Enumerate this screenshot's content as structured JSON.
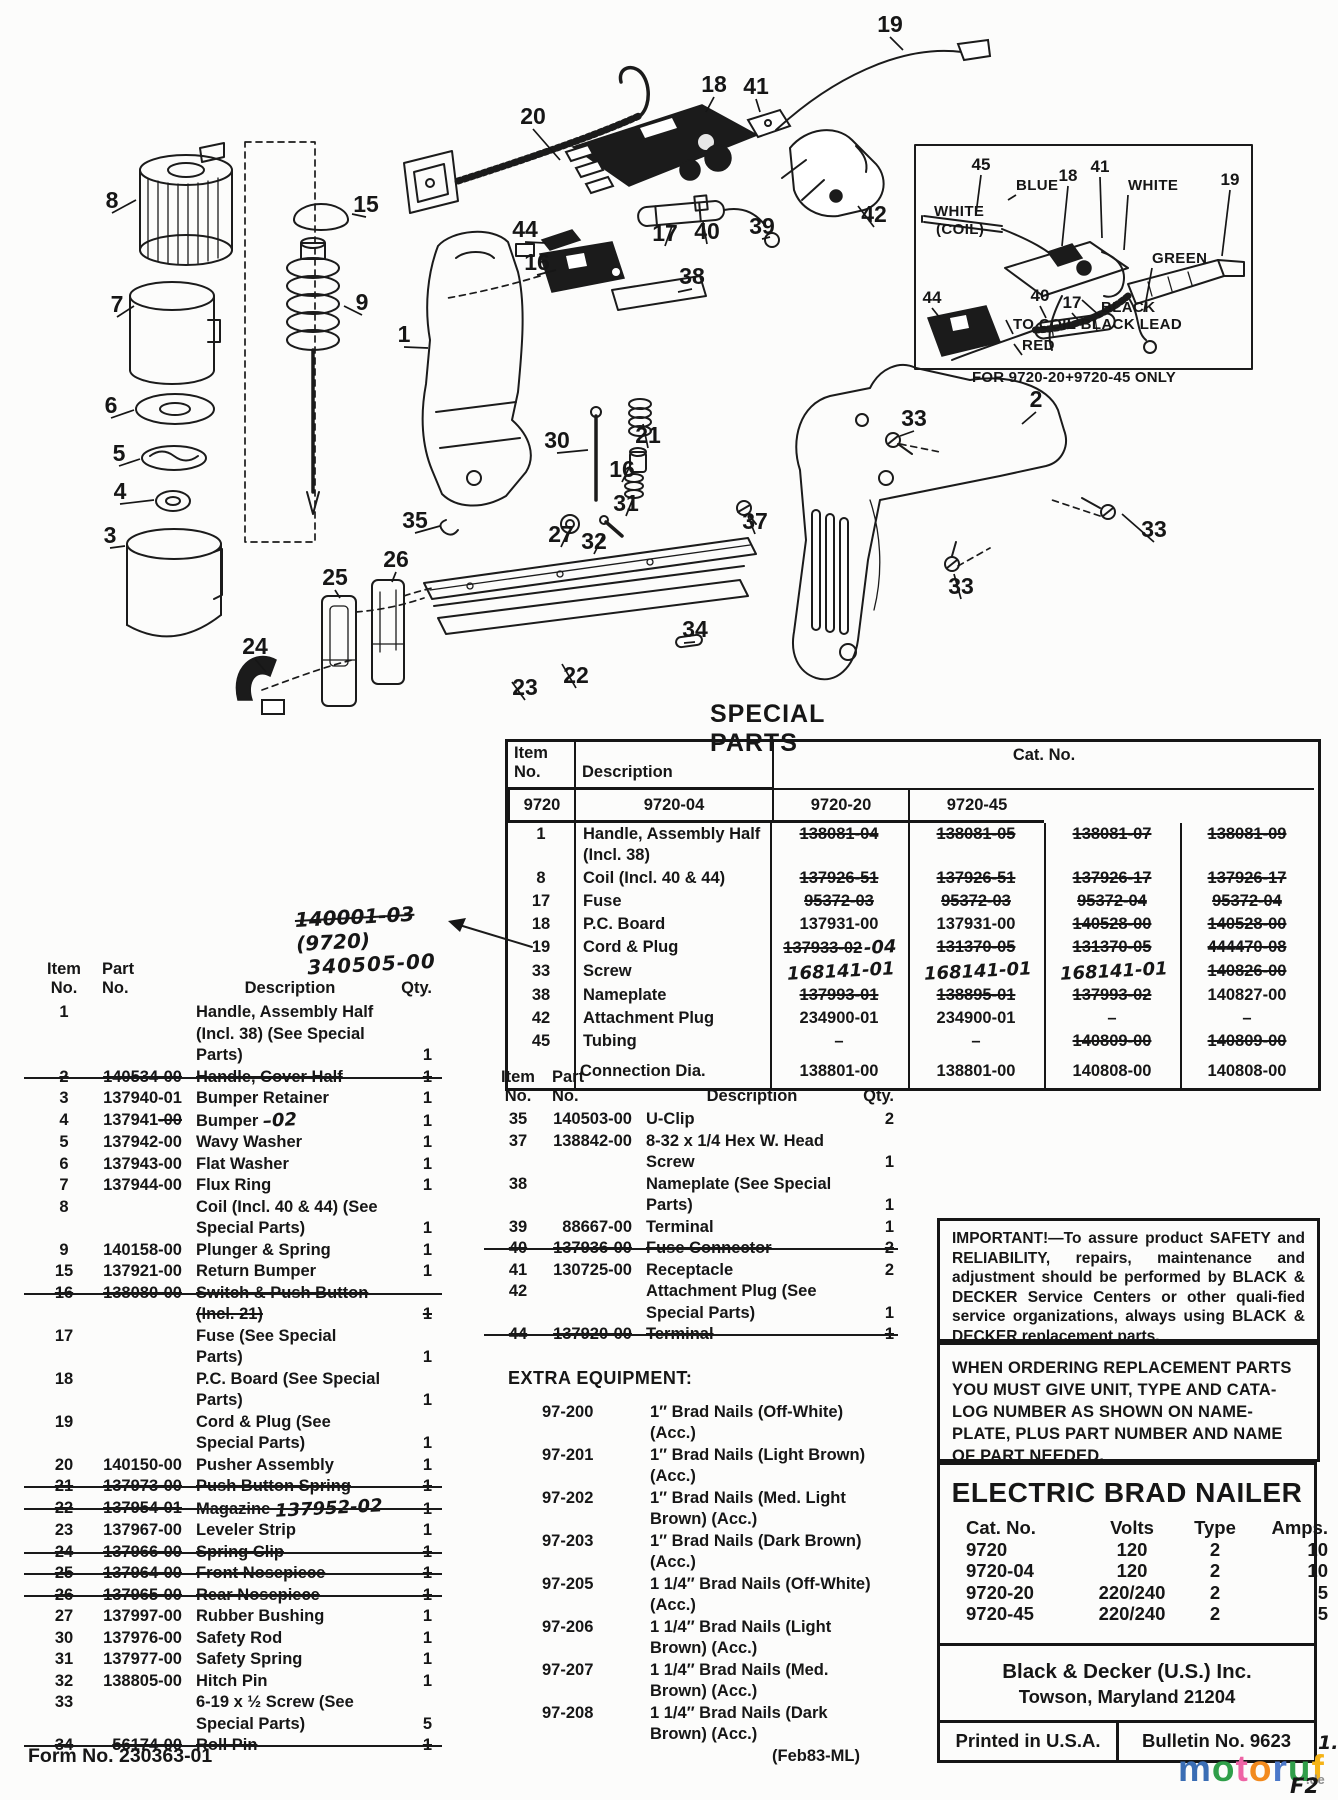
{
  "diagram": {
    "inset_caption": "FOR 9720-20+9720-45 ONLY",
    "callouts": [
      {
        "n": "19",
        "x": 890,
        "y": 32,
        "lx": 903,
        "ly": 50
      },
      {
        "n": "18",
        "x": 714,
        "y": 92,
        "lx": 706,
        "ly": 112
      },
      {
        "n": "41",
        "x": 756,
        "y": 94,
        "lx": 760,
        "ly": 112
      },
      {
        "n": "20",
        "x": 533,
        "y": 124,
        "lx": 560,
        "ly": 160
      },
      {
        "n": "8",
        "x": 112,
        "y": 208,
        "lx": 136,
        "ly": 200
      },
      {
        "n": "15",
        "x": 366,
        "y": 212,
        "lx": 352,
        "ly": 214
      },
      {
        "n": "44",
        "x": 525,
        "y": 237,
        "lx": 546,
        "ly": 243
      },
      {
        "n": "16",
        "x": 537,
        "y": 270,
        "lx": 556,
        "ly": 270
      },
      {
        "n": "17",
        "x": 665,
        "y": 241,
        "lx": 672,
        "ly": 226
      },
      {
        "n": "40",
        "x": 707,
        "y": 239,
        "lx": 703,
        "ly": 222
      },
      {
        "n": "39",
        "x": 762,
        "y": 234,
        "lx": 770,
        "ly": 237
      },
      {
        "n": "42",
        "x": 874,
        "y": 222,
        "lx": 858,
        "ly": 206
      },
      {
        "n": "38",
        "x": 692,
        "y": 284,
        "lx": 678,
        "ly": 292
      },
      {
        "n": "9",
        "x": 362,
        "y": 310,
        "lx": 344,
        "ly": 306
      },
      {
        "n": "7",
        "x": 117,
        "y": 312,
        "lx": 134,
        "ly": 306
      },
      {
        "n": "1",
        "x": 404,
        "y": 342,
        "lx": 428,
        "ly": 348
      },
      {
        "n": "2",
        "x": 1036,
        "y": 407,
        "lx": 1022,
        "ly": 424
      },
      {
        "n": "33",
        "x": 914,
        "y": 426,
        "lx": 900,
        "ly": 436
      },
      {
        "n": "6",
        "x": 111,
        "y": 413,
        "lx": 134,
        "ly": 410
      },
      {
        "n": "5",
        "x": 119,
        "y": 461,
        "lx": 140,
        "ly": 459
      },
      {
        "n": "4",
        "x": 120,
        "y": 499,
        "lx": 154,
        "ly": 500
      },
      {
        "n": "30",
        "x": 557,
        "y": 448,
        "lx": 588,
        "ly": 450
      },
      {
        "n": "21",
        "x": 648,
        "y": 443,
        "lx": 643,
        "ly": 424
      },
      {
        "n": "16",
        "x": 622,
        "y": 477,
        "lx": 632,
        "ly": 462
      },
      {
        "n": "31",
        "x": 626,
        "y": 511,
        "lx": 634,
        "ly": 496
      },
      {
        "n": "3",
        "x": 110,
        "y": 543,
        "lx": 125,
        "ly": 546
      },
      {
        "n": "35",
        "x": 415,
        "y": 528,
        "lx": 440,
        "ly": 526
      },
      {
        "n": "27",
        "x": 561,
        "y": 542,
        "lx": 568,
        "ly": 532
      },
      {
        "n": "32",
        "x": 594,
        "y": 549,
        "lx": 604,
        "ly": 534
      },
      {
        "n": "37",
        "x": 755,
        "y": 529,
        "lx": 748,
        "ly": 516
      },
      {
        "n": "33",
        "x": 1154,
        "y": 537,
        "lx": 1122,
        "ly": 514
      },
      {
        "n": "25",
        "x": 335,
        "y": 585,
        "lx": 340,
        "ly": 598
      },
      {
        "n": "26",
        "x": 396,
        "y": 567,
        "lx": 392,
        "ly": 582
      },
      {
        "n": "33",
        "x": 961,
        "y": 594,
        "lx": 954,
        "ly": 574
      },
      {
        "n": "24",
        "x": 255,
        "y": 654,
        "lx": 266,
        "ly": 672
      },
      {
        "n": "34",
        "x": 695,
        "y": 637,
        "lx": 684,
        "ly": 643
      },
      {
        "n": "23",
        "x": 525,
        "y": 695,
        "lx": 512,
        "ly": 682
      },
      {
        "n": "22",
        "x": 576,
        "y": 683,
        "lx": 562,
        "ly": 664
      },
      {
        "n": "45",
        "x": 981,
        "y": 170,
        "cls": "n2",
        "lx": 976,
        "ly": 214
      },
      {
        "n": "18",
        "x": 1068,
        "y": 181,
        "cls": "n2",
        "lx": 1062,
        "ly": 246
      },
      {
        "n": "41",
        "x": 1100,
        "y": 172,
        "cls": "n2",
        "lx": 1102,
        "ly": 238
      },
      {
        "n": "19",
        "x": 1230,
        "y": 185,
        "cls": "n2",
        "lx": 1222,
        "ly": 256
      },
      {
        "n": "40",
        "x": 1040,
        "y": 301,
        "cls": "n2",
        "lx": 1046,
        "ly": 318
      },
      {
        "n": "17",
        "x": 1072,
        "y": 308,
        "cls": "n2",
        "lx": 1078,
        "ly": 320
      },
      {
        "n": "44",
        "x": 932,
        "y": 303,
        "cls": "n2",
        "lx": 940,
        "ly": 318
      },
      {
        "n": "BLUE",
        "x": 1016,
        "y": 190,
        "cls": "w",
        "lx": 1008,
        "ly": 200
      },
      {
        "n": "WHITE",
        "x": 1128,
        "y": 190,
        "cls": "w",
        "lx": 1124,
        "ly": 250
      },
      {
        "n": "WHITE",
        "x": 934,
        "y": 216,
        "cls": "w"
      },
      {
        "n": "(COIL)",
        "x": 936,
        "y": 234,
        "cls": "w"
      },
      {
        "n": "GREEN",
        "x": 1152,
        "y": 263,
        "cls": "w",
        "lx": 1144,
        "ly": 312
      },
      {
        "n": "BLACK",
        "x": 1101,
        "y": 312,
        "cls": "w",
        "lx": 1082,
        "ly": 300
      },
      {
        "n": "TO COIL BLACK LEAD",
        "x": 1013,
        "y": 329,
        "cls": "w",
        "lx": 1006,
        "ly": 320
      },
      {
        "n": "RED",
        "x": 1022,
        "y": 350,
        "cls": "w",
        "lx": 1014,
        "ly": 344
      }
    ]
  },
  "special_parts": {
    "title": "SPECIAL PARTS",
    "header": {
      "item": "Item No.",
      "desc": "Description",
      "cat": "Cat. No.",
      "models": [
        "9720",
        "9720-04",
        "9720-20",
        "9720-45"
      ]
    },
    "annotation": {
      "struck": "140001-03",
      "tail": "(9720)",
      "line2": "340505-00"
    },
    "rows": [
      {
        "item": "1",
        "desc": "Handle, Assembly Half (Incl. 38)",
        "v1": "138081-04",
        "s1": 1,
        "v2": "138081-05",
        "s2": 1,
        "v3": "138081-07",
        "s3": 1,
        "v4": "138081-09",
        "s4": 1
      },
      {
        "item": "8",
        "desc": "Coil (Incl. 40 & 44)",
        "v1": "137926-51",
        "s1": 1,
        "v2": "137926-51",
        "s2": 1,
        "v3": "137926-17",
        "s3": 1,
        "v4": "137926-17",
        "s4": 1
      },
      {
        "item": "17",
        "desc": "Fuse",
        "v1": "95372-03",
        "s1": 1,
        "v2": "95372-03",
        "s2": 1,
        "v3": "95372-04",
        "s3": 1,
        "v4": "95372-04",
        "s4": 1
      },
      {
        "item": "18",
        "desc": "P.C. Board",
        "v1": "137931-00",
        "v2": "137931-00",
        "v3": "140528-00",
        "s3": 1,
        "v4": "140528-00",
        "s4": 1
      },
      {
        "item": "19",
        "desc": "Cord & Plug",
        "v1": "137933-02",
        "s1": 1,
        "h1": "-04",
        "v2": "131370-05",
        "s2": 1,
        "v3": "131370-05",
        "s3": 1,
        "v4": "444470-08",
        "s4": 1
      },
      {
        "item": "33",
        "desc": "Screw",
        "h1": "168141-01",
        "h2": "168141-01",
        "h3": "168141-01",
        "v4": "140826-00",
        "s4": 1
      },
      {
        "item": "38",
        "desc": "Nameplate",
        "v1": "137993-01",
        "s1": 1,
        "v2": "138895-01",
        "s2": 1,
        "v3": "137993-02",
        "s3": 1,
        "v4": "140827-00"
      },
      {
        "item": "42",
        "desc": "Attachment Plug",
        "v1": "234900-01",
        "v2": "234900-01",
        "v3": "–",
        "v4": "–"
      },
      {
        "item": "45",
        "desc": "Tubing",
        "v1": "–",
        "v2": "–",
        "v3": "140809-00",
        "s3": 1,
        "v4": "140809-00",
        "s4": 1
      },
      {
        "item": "",
        "desc": "Connection Dia.",
        "v1": "138801-00",
        "v2": "138801-00",
        "v3": "140808-00",
        "v4": "140808-00",
        "last": 1
      }
    ]
  },
  "left_list": {
    "header": {
      "item": "Item",
      "item2": "No.",
      "part": "Part",
      "part2": "No.",
      "desc": "Description",
      "qty": "Qty."
    },
    "rows": [
      {
        "no": "1",
        "desc": "Handle, Assembly Half (Incl. 38) (See Special Parts)",
        "qty": "1"
      },
      {
        "no": "2",
        "part": "140534-00",
        "desc": "Handle, Cover Half",
        "qty": "1",
        "struck": 1
      },
      {
        "no": "3",
        "part": "137940-01",
        "desc": "Bumper Retainer",
        "qty": "1"
      },
      {
        "no": "4",
        "part": "137941",
        "part_tail": "-00",
        "desc": "Bumper",
        "hw": "–02",
        "qty": "1"
      },
      {
        "no": "5",
        "part": "137942-00",
        "desc": "Wavy Washer",
        "qty": "1"
      },
      {
        "no": "6",
        "part": "137943-00",
        "desc": "Flat Washer",
        "qty": "1"
      },
      {
        "no": "7",
        "part": "137944-00",
        "desc": "Flux Ring",
        "qty": "1"
      },
      {
        "no": "8",
        "desc": "Coil (Incl. 40 & 44) (See Special Parts)",
        "qty": "1"
      },
      {
        "no": "9",
        "part": "140158-00",
        "desc": "Plunger & Spring",
        "qty": "1"
      },
      {
        "no": "15",
        "part": "137921-00",
        "desc": "Return Bumper",
        "qty": "1"
      },
      {
        "no": "16",
        "part": "138080-00",
        "desc": "Switch & Push Button (Incl. 21)",
        "qty": "1",
        "struck": 1
      },
      {
        "no": "17",
        "desc": "Fuse (See Special Parts)",
        "qty": "1"
      },
      {
        "no": "18",
        "desc": "P.C. Board (See Special Parts)",
        "qty": "1"
      },
      {
        "no": "19",
        "desc": "Cord & Plug (See Special Parts)",
        "qty": "1"
      },
      {
        "no": "20",
        "part": "140150-00",
        "desc": "Pusher Assembly",
        "qty": "1"
      },
      {
        "no": "21",
        "part": "137973-00",
        "desc": "Push Button Spring",
        "qty": "1",
        "struck": 1
      },
      {
        "no": "22",
        "part": "137954-01",
        "desc": "Magazine",
        "hw": "137952-02",
        "qty": "1",
        "struck": 1
      },
      {
        "no": "23",
        "part": "137967-00",
        "desc": "Leveler Strip",
        "qty": "1"
      },
      {
        "no": "24",
        "part": "137966-00",
        "desc": "Spring Clip",
        "qty": "1",
        "struck": 1
      },
      {
        "no": "25",
        "part": "137964-00",
        "desc": "Front Nosepiece",
        "qty": "1",
        "struck": 1
      },
      {
        "no": "26",
        "part": "137965-00",
        "desc": "Rear Nosepiece",
        "qty": "1",
        "struck": 1
      },
      {
        "no": "27",
        "part": "137997-00",
        "desc": "Rubber Bushing",
        "qty": "1"
      },
      {
        "no": "30",
        "part": "137976-00",
        "desc": "Safety Rod",
        "qty": "1"
      },
      {
        "no": "31",
        "part": "137977-00",
        "desc": "Safety Spring",
        "qty": "1"
      },
      {
        "no": "32",
        "part": "138805-00",
        "desc": "Hitch Pin",
        "qty": "1"
      },
      {
        "no": "33",
        "desc": "6-19 x ½ Screw (See Special Parts)",
        "qty": "5"
      },
      {
        "no": "34",
        "part": "56174-00",
        "desc": "Roll Pin",
        "qty": "1",
        "struck": 1
      }
    ]
  },
  "mid_list": {
    "header": {
      "item": "Item",
      "item2": "No.",
      "part": "Part",
      "part2": "No.",
      "desc": "Description",
      "qty": "Qty."
    },
    "rows": [
      {
        "no": "35",
        "part": "140503-00",
        "desc": "U-Clip",
        "qty": "2"
      },
      {
        "no": "37",
        "part": "138842-00",
        "desc": "8-32 x 1/4 Hex W. Head Screw",
        "qty": "1"
      },
      {
        "no": "38",
        "desc": "Nameplate (See Special Parts)",
        "qty": "1"
      },
      {
        "no": "39",
        "part": "88667-00",
        "desc": "Terminal",
        "qty": "1"
      },
      {
        "no": "40",
        "part": "137936-00",
        "desc": "Fuse Connector",
        "qty": "2",
        "struck": 1
      },
      {
        "no": "41",
        "part": "130725-00",
        "desc": "Receptacle",
        "qty": "2"
      },
      {
        "no": "42",
        "desc": "Attachment Plug (See Special Parts)",
        "qty": "1"
      },
      {
        "no": "44",
        "part": "137920-00",
        "desc": "Terminal",
        "qty": "1",
        "struck": 1
      }
    ]
  },
  "extra_equipment": {
    "title": "EXTRA EQUIPMENT:",
    "rows": [
      {
        "cat": "97-200",
        "desc": "1″ Brad Nails (Off-White) (Acc.)"
      },
      {
        "cat": "97-201",
        "desc": "1″ Brad Nails (Light Brown) (Acc.)"
      },
      {
        "cat": "97-202",
        "desc": "1″ Brad Nails (Med. Light Brown) (Acc.)"
      },
      {
        "cat": "97-203",
        "desc": "1″ Brad Nails (Dark Brown) (Acc.)"
      },
      {
        "cat": "97-205",
        "desc": "1 1/4″ Brad Nails (Off-White) (Acc.)"
      },
      {
        "cat": "97-206",
        "desc": "1 1/4″ Brad Nails (Light Brown) (Acc.)"
      },
      {
        "cat": "97-207",
        "desc": "1 1/4″ Brad Nails (Med. Brown) (Acc.)"
      },
      {
        "cat": "97-208",
        "desc": "1 1/4″ Brad Nails (Dark Brown) (Acc.)"
      }
    ]
  },
  "notices": {
    "important_title": "IMPORTANT!",
    "important_body": "—To assure product SAFETY and RELIABILITY, repairs, maintenance and adjustment should be performed by BLACK & DECKER Service Centers or other quali-fied service organizations, always using BLACK & DECKER replacement parts.",
    "ordering": "WHEN ORDERING REPLACEMENT PARTS YOU MUST GIVE UNIT, TYPE AND CATA-LOG NUMBER AS SHOWN ON NAME-PLATE, PLUS PART NUMBER AND NAME OF PART NEEDED."
  },
  "nameplate": {
    "title": "ELECTRIC BRAD NAILER",
    "cols": [
      "Cat. No.",
      "Volts",
      "Type",
      "Amps."
    ],
    "rows": [
      [
        "9720",
        "120",
        "2",
        "10"
      ],
      [
        "9720-04",
        "120",
        "2",
        "10"
      ],
      [
        "9720-20",
        "220/240",
        "2",
        "5"
      ],
      [
        "9720-45",
        "220/240",
        "2",
        "5"
      ]
    ],
    "company": "Black & Decker (U.S.) Inc.",
    "address": "Towson, Maryland 21204",
    "printed": "Printed in U.S.A.",
    "bulletin": "Bulletin No. 9623"
  },
  "footer": {
    "form_no": "Form No. 230363-01",
    "date_code": "(Feb83-ML)"
  },
  "watermark": {
    "letters": [
      {
        "ch": "m",
        "color": "#3a6db4"
      },
      {
        "ch": "o",
        "color": "#2f9e49"
      },
      {
        "ch": "t",
        "color": "#ee64a5"
      },
      {
        "ch": "o",
        "color": "#f28a1e"
      },
      {
        "ch": "r",
        "color": "#4a77c9"
      },
      {
        "ch": "u",
        "color": "#2f9e49"
      },
      {
        "ch": "f",
        "color": "#f5b317"
      }
    ],
    "suffix": ".de",
    "mark_top": "1.",
    "mark_bottom": "F2"
  }
}
